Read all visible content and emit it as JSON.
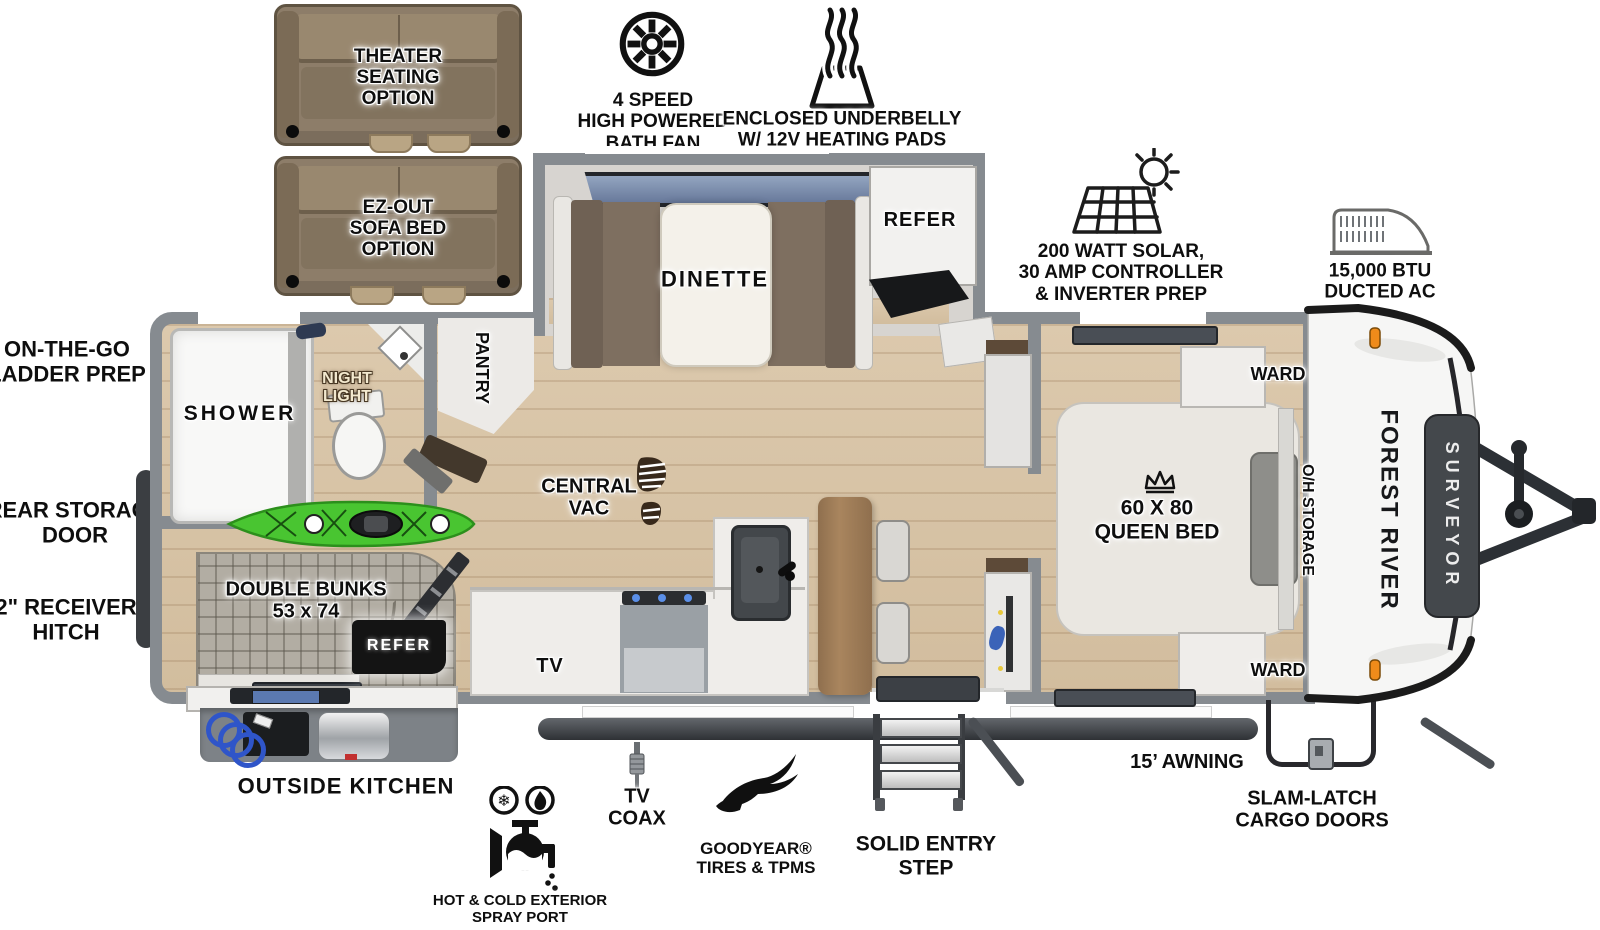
{
  "brand": {
    "maker": "FOREST RIVER",
    "model": "SURVEYOR"
  },
  "slide_options": {
    "theater": "THEATER\nSEATING OPTION",
    "ez_sofa": "EZ-OUT\nSOFA BED\nOPTION"
  },
  "callouts_top": {
    "bath_fan": "4 SPEED\nHIGH POWERED\nBATH FAN",
    "underbelly": "ENCLOSED UNDERBELLY\nW/ 12V HEATING PADS",
    "solar": "200 WATT SOLAR,\n30 AMP CONTROLLER\n& INVERTER PREP",
    "ducted_ac": "15,000 BTU\nDUCTED AC"
  },
  "callouts_left": {
    "ladder_prep": "ON-THE-GO\nLADDER PREP",
    "rear_storage_door": "REAR STORAGE\nDOOR",
    "receiver_hitch": "2\" RECEIVER\nHITCH"
  },
  "callouts_bottom": {
    "outside_kitchen": "OUTSIDE KITCHEN",
    "spray_port": "HOT & COLD EXTERIOR\nSPRAY PORT",
    "tv_coax": "TV\nCOAX",
    "tires": "GOODYEAR®\nTIRES & TPMS",
    "entry_step": "SOLID ENTRY\nSTEP",
    "awning": "15’ AWNING",
    "cargo_doors": "SLAM-LATCH\nCARGO DOORS"
  },
  "rooms": {
    "shower": "SHOWER",
    "night_light": "NIGHT\nLIGHT",
    "pantry": "PANTRY",
    "dinette": "DINETTE",
    "refer_slide": "REFER",
    "central_vac": "CENTRAL\nVAC",
    "tv": "TV",
    "double_bunks": "DOUBLE BUNKS\n53 x 74",
    "refer_bunks": "REFER",
    "queen_bed": "60 X 80\nQUEEN BED",
    "ward_front": "WARD",
    "ward_rear": "WARD",
    "oh_storage": "O/H STORAGE"
  },
  "icons": {
    "snowflake": "❄"
  },
  "colors": {
    "wall": "#868b90",
    "floor": "#d9c6aa",
    "kayak_green": "#49c531",
    "sofa_brown": "#8d7d69"
  }
}
